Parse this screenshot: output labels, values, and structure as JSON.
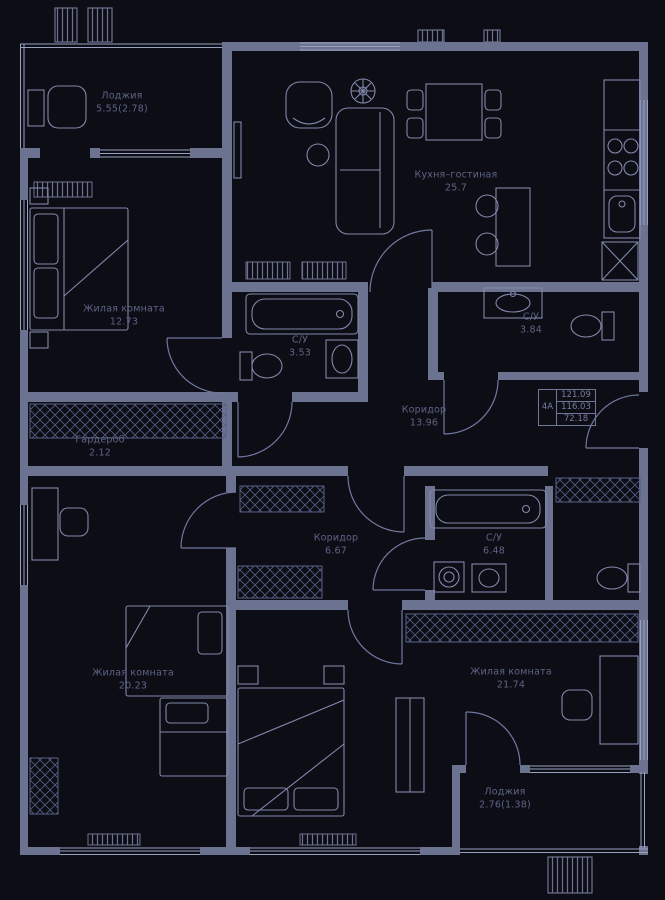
{
  "palette": {
    "background": "#0d0d15",
    "wall": "#6c7390",
    "furniture_line": "#8089ab",
    "hatch_line": "#566086",
    "window_line": "#9aa2c2",
    "door_arc": "#6f79a0",
    "label_text": "#5d6588",
    "stamp_text": "#767ea2"
  },
  "plan": {
    "rooms": [
      {
        "id": "loggia-top",
        "name": "Лоджия",
        "area": "5.55(2.78)"
      },
      {
        "id": "kitchen-living",
        "name": "Кухня–гостиная",
        "area": "25.7"
      },
      {
        "id": "bedroom-left",
        "name": "Жилая комната",
        "area": "12.73"
      },
      {
        "id": "bathroom-center",
        "name": "С/У",
        "area": "3.53"
      },
      {
        "id": "bathroom-right",
        "name": "С/У",
        "area": "3.84"
      },
      {
        "id": "hall",
        "name": "Коридор",
        "area": "13.96"
      },
      {
        "id": "wardrobe",
        "name": "Гардероб",
        "area": "2.12"
      },
      {
        "id": "corridor-lower",
        "name": "Коридор",
        "area": "6.67"
      },
      {
        "id": "bathroom-lower",
        "name": "С/У",
        "area": "6.48"
      },
      {
        "id": "bedroom-bottom-left",
        "name": "Жилая комната",
        "area": "20.23"
      },
      {
        "id": "bedroom-bottom-right",
        "name": "Жилая комната",
        "area": "21.74"
      },
      {
        "id": "loggia-bottom",
        "name": "Лоджия",
        "area": "2.76(1.38)"
      }
    ],
    "stamp": {
      "unit": "4А",
      "total_area": "121.09",
      "floor_area": "116.03",
      "living_area": "72.18"
    }
  }
}
